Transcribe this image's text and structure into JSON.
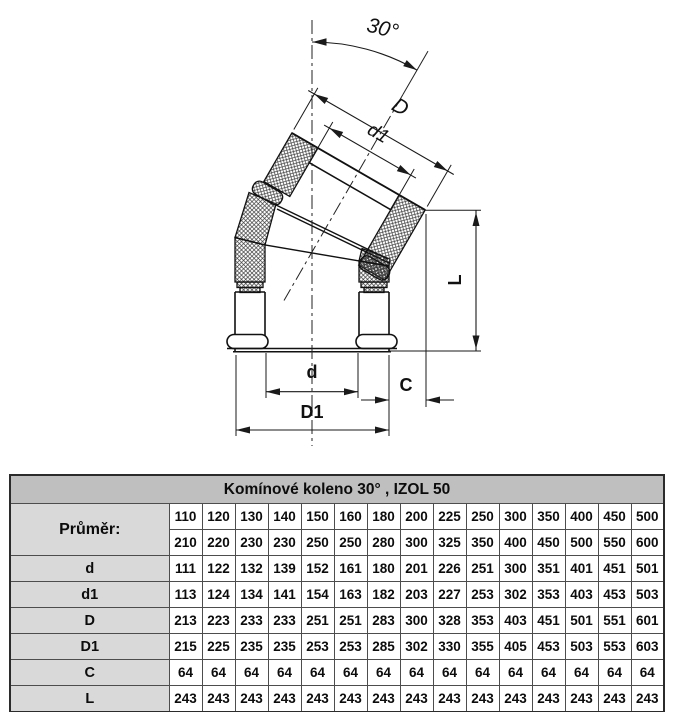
{
  "drawing": {
    "angle_label": "30°",
    "labels": {
      "D": "D",
      "d1": "d1",
      "d": "d",
      "D1": "D1",
      "C": "C",
      "L": "L"
    }
  },
  "table": {
    "title": "Komínové koleno 30° , IZOL 50",
    "rows": [
      {
        "label": "Průměr:",
        "rowspan": 2,
        "big": true,
        "values": [
          "110",
          "120",
          "130",
          "140",
          "150",
          "160",
          "180",
          "200",
          "225",
          "250",
          "300",
          "350",
          "400",
          "450",
          "500"
        ]
      },
      {
        "label": null,
        "values": [
          "210",
          "220",
          "230",
          "230",
          "250",
          "250",
          "280",
          "300",
          "325",
          "350",
          "400",
          "450",
          "500",
          "550",
          "600"
        ]
      },
      {
        "label": "d",
        "values": [
          "111",
          "122",
          "132",
          "139",
          "152",
          "161",
          "180",
          "201",
          "226",
          "251",
          "300",
          "351",
          "401",
          "451",
          "501"
        ]
      },
      {
        "label": "d1",
        "values": [
          "113",
          "124",
          "134",
          "141",
          "154",
          "163",
          "182",
          "203",
          "227",
          "253",
          "302",
          "353",
          "403",
          "453",
          "503"
        ]
      },
      {
        "label": "D",
        "values": [
          "213",
          "223",
          "233",
          "233",
          "251",
          "251",
          "283",
          "300",
          "328",
          "353",
          "403",
          "451",
          "501",
          "551",
          "601"
        ]
      },
      {
        "label": "D1",
        "values": [
          "215",
          "225",
          "235",
          "235",
          "253",
          "253",
          "285",
          "302",
          "330",
          "355",
          "405",
          "453",
          "503",
          "553",
          "603"
        ]
      },
      {
        "label": "C",
        "values": [
          "64",
          "64",
          "64",
          "64",
          "64",
          "64",
          "64",
          "64",
          "64",
          "64",
          "64",
          "64",
          "64",
          "64",
          "64"
        ]
      },
      {
        "label": "L",
        "values": [
          "243",
          "243",
          "243",
          "243",
          "243",
          "243",
          "243",
          "243",
          "243",
          "243",
          "243",
          "243",
          "243",
          "243",
          "243"
        ]
      }
    ]
  },
  "colors": {
    "background": "#ffffff",
    "table_header_bg": "#bfbfbf",
    "table_label_bg": "#d9d9d9",
    "line": "#1a1a1a"
  }
}
